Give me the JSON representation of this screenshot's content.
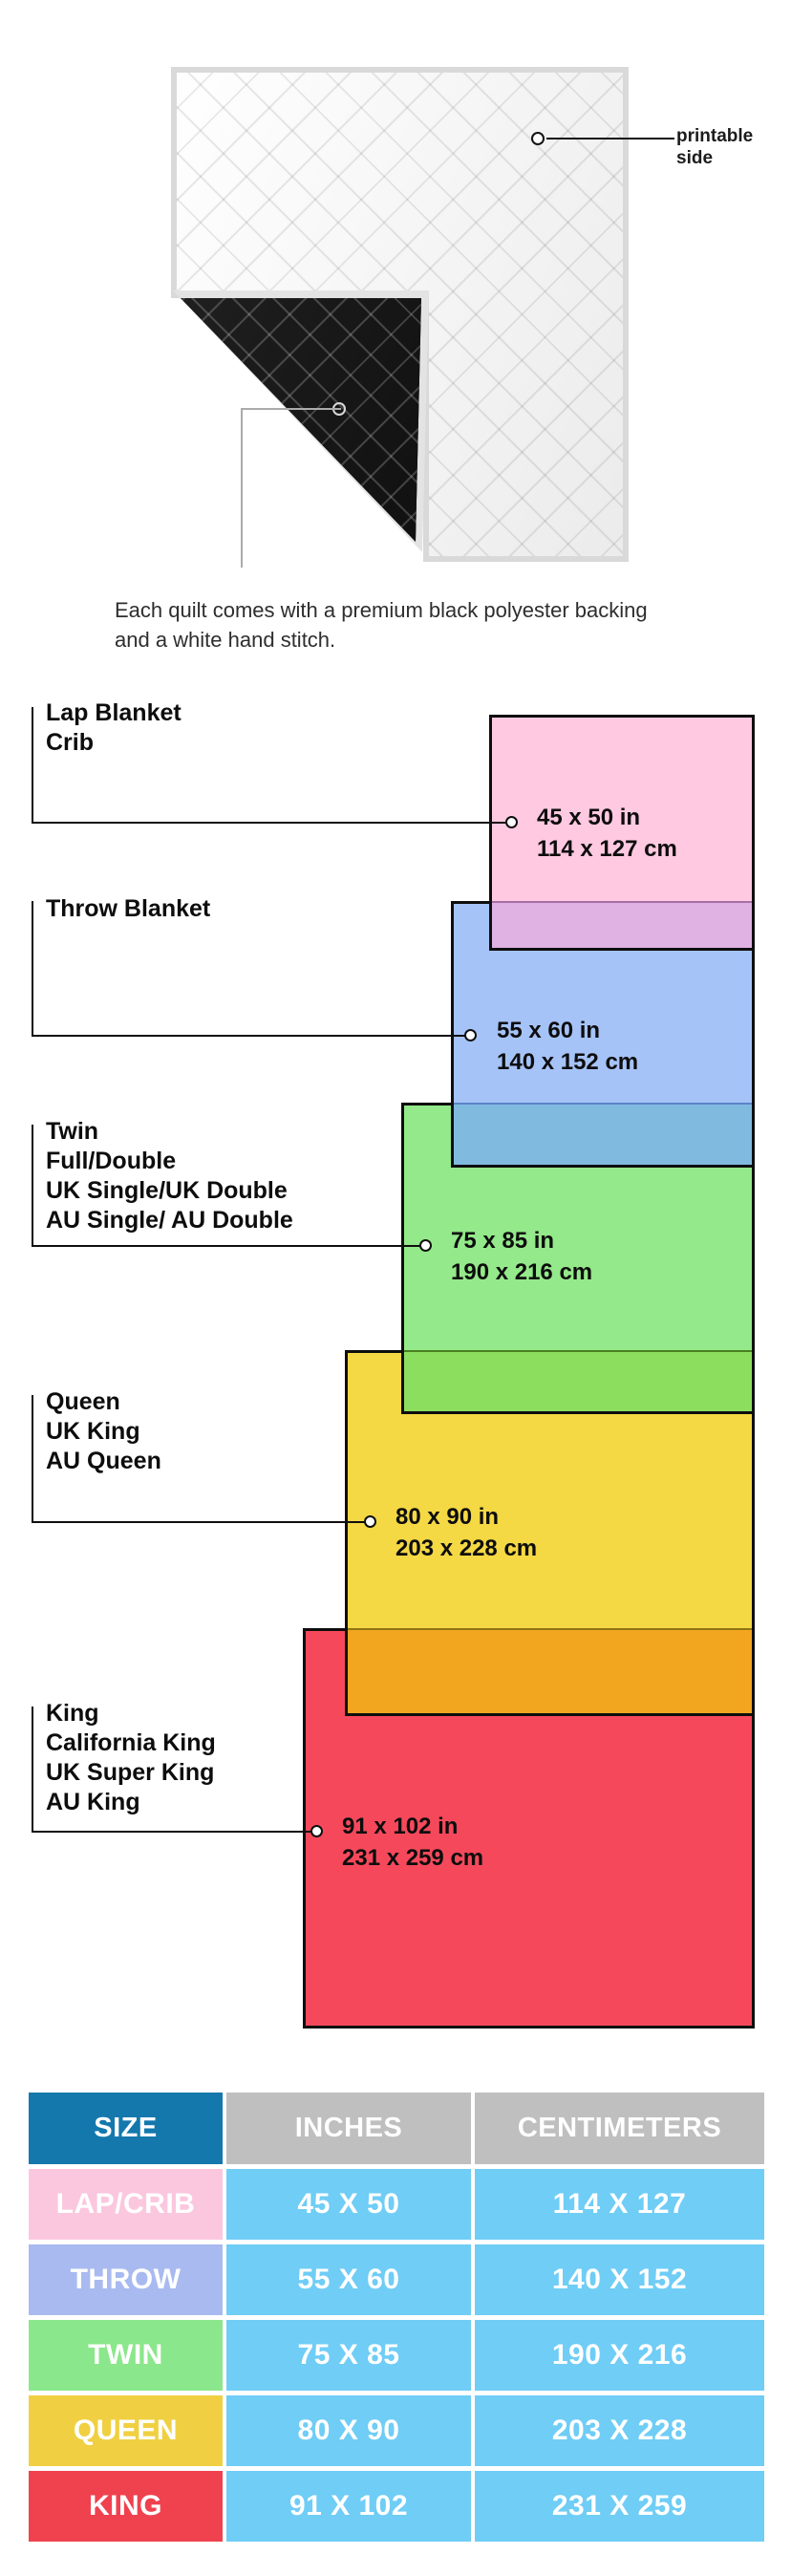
{
  "hero": {
    "printable_callout": {
      "line1": "printable",
      "line2": "side"
    },
    "caption": "Each quilt comes with a premium black polyester backing and a white hand stitch.",
    "quilt_front_color": "#f7f7f7",
    "quilt_backing_color": "#161616"
  },
  "diagram": {
    "border_color": "#0e0e0e",
    "groups": [
      {
        "labels": [
          "Lap Blanket",
          "Crib"
        ],
        "inches": "45 x 50 in",
        "cm": "114 x 127 cm",
        "color": "#ffc9e1",
        "overlap_color": "#dfb2e3"
      },
      {
        "labels": [
          "Throw Blanket"
        ],
        "inches": "55 x 60 in",
        "cm": "140 x 152 cm",
        "color": "#a6c3f8",
        "overlap_color": "#80badf"
      },
      {
        "labels": [
          "Twin",
          "Full/Double",
          "UK Single/UK Double",
          "AU Single/ AU Double"
        ],
        "inches": "75 x 85 in",
        "cm": "190 x 216 cm",
        "color": "#94e98a",
        "overlap_color": "#8cde5e"
      },
      {
        "labels": [
          "Queen",
          "UK King",
          "AU Queen"
        ],
        "inches": "80 x 90 in",
        "cm": "203 x 228 cm",
        "color": "#f4d844",
        "overlap_color": "#f2a61f"
      },
      {
        "labels": [
          "King",
          "California King",
          "UK Super King",
          "AU King"
        ],
        "inches": "91 x 102 in",
        "cm": "231 x 259 cm",
        "color": "#f5495b",
        "overlap_color": null
      }
    ]
  },
  "table": {
    "headers": [
      "SIZE",
      "INCHES",
      "CENTIMETERS"
    ],
    "header_size_color": "#1478ad",
    "header_other_color": "#bfbfbf",
    "cell_color": "#6fcdf6",
    "rows": [
      {
        "size": "LAP/CRIB",
        "inches": "45 X 50",
        "cm": "114 X 127",
        "color": "#fbc7de"
      },
      {
        "size": "THROW",
        "inches": "55 X 60",
        "cm": "140 X 152",
        "color": "#a9baf0"
      },
      {
        "size": "TWIN",
        "inches": "75 X 85",
        "cm": "190 X 216",
        "color": "#8be78b"
      },
      {
        "size": "QUEEN",
        "inches": "80 X 90",
        "cm": "203 X 228",
        "color": "#f0d042"
      },
      {
        "size": "KING",
        "inches": "91 X 102",
        "cm": "231 X 259",
        "color": "#f0414f"
      }
    ]
  }
}
